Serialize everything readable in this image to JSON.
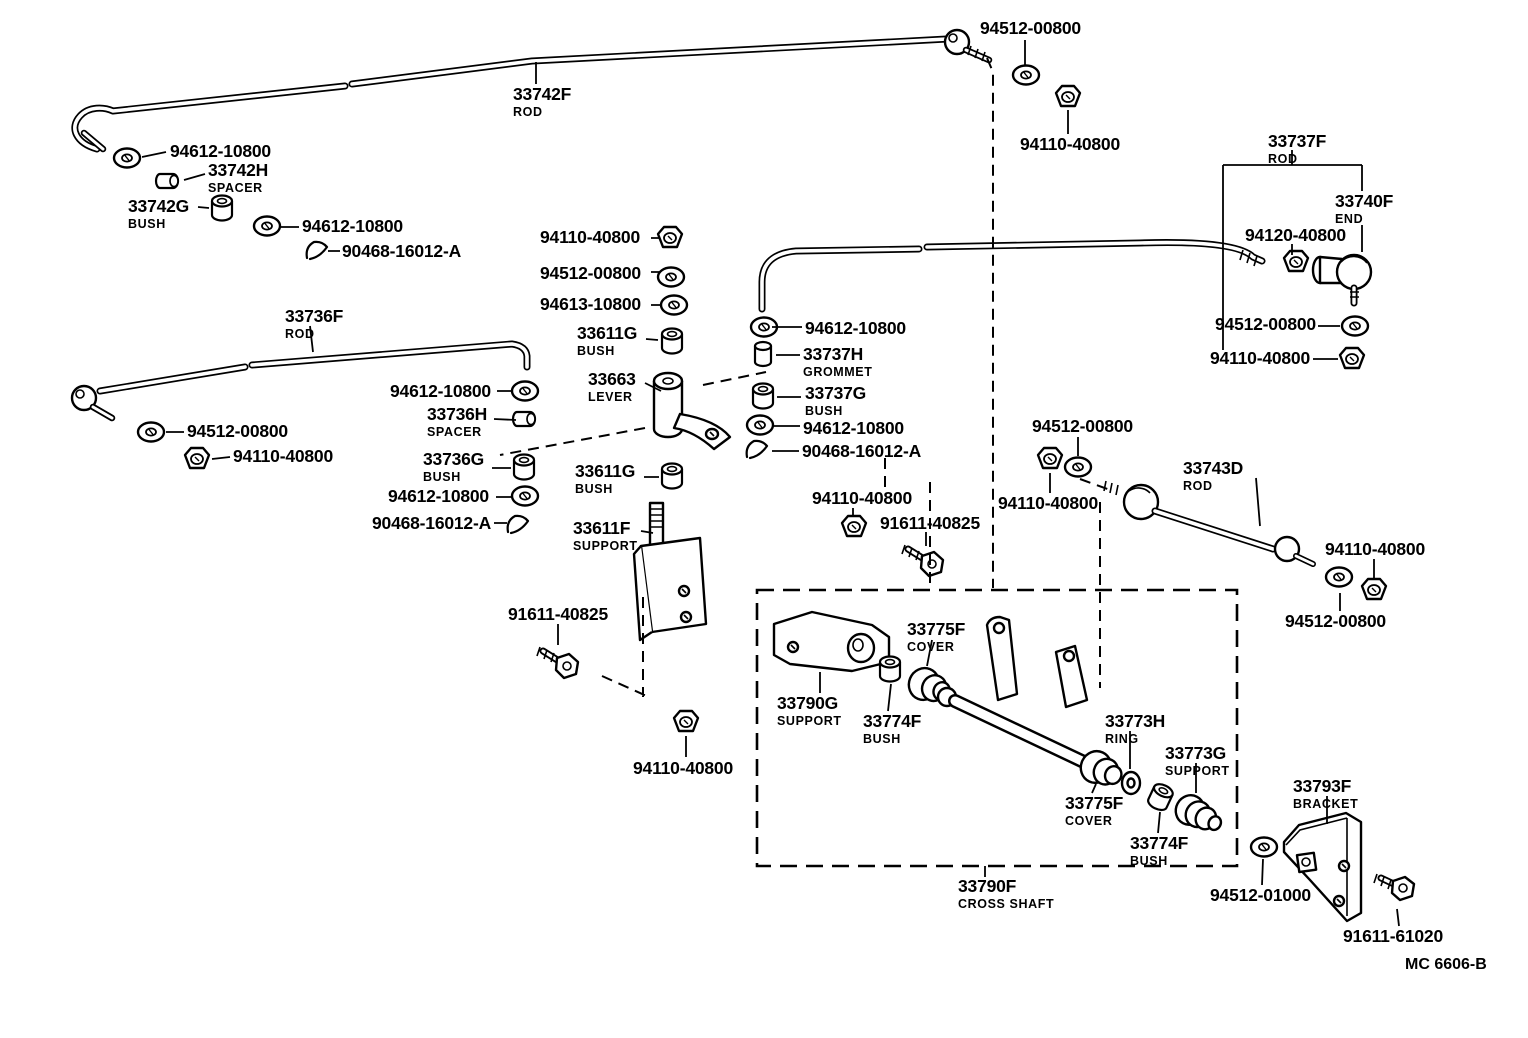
{
  "diagram": {
    "title": "Control shaft & crossshaft parts diagram",
    "drawing_code": "MC 6606-B",
    "colors": {
      "ink": "#000000",
      "paper": "#ffffff"
    },
    "labels": [
      {
        "part": "94512-00800",
        "desc": "",
        "x": 980,
        "y": 20
      },
      {
        "part": "94110-40800",
        "desc": "",
        "x": 1020,
        "y": 136
      },
      {
        "part": "94612-10800",
        "desc": "",
        "x": 170,
        "y": 143
      },
      {
        "part": "33742H",
        "desc": "SPACER",
        "x": 208,
        "y": 162
      },
      {
        "part": "33742G",
        "desc": "BUSH",
        "x": 128,
        "y": 198
      },
      {
        "part": "94612-10800",
        "desc": "",
        "x": 302,
        "y": 218
      },
      {
        "part": "90468-16012-A",
        "desc": "",
        "x": 342,
        "y": 243
      },
      {
        "part": "33742F",
        "desc": "ROD",
        "x": 513,
        "y": 86
      },
      {
        "part": "33737F",
        "desc": "ROD",
        "x": 1268,
        "y": 133
      },
      {
        "part": "33740F",
        "desc": "END",
        "x": 1335,
        "y": 193
      },
      {
        "part": "94120-40800",
        "desc": "",
        "x": 1245,
        "y": 227
      },
      {
        "part": "94110-40800",
        "desc": "",
        "x": 540,
        "y": 229
      },
      {
        "part": "94512-00800",
        "desc": "",
        "x": 540,
        "y": 265
      },
      {
        "part": "94613-10800",
        "desc": "",
        "x": 540,
        "y": 296
      },
      {
        "part": "33611G",
        "desc": "BUSH",
        "x": 577,
        "y": 325
      },
      {
        "part": "94612-10800",
        "desc": "",
        "x": 805,
        "y": 320
      },
      {
        "part": "33737H",
        "desc": "GROMMET",
        "x": 803,
        "y": 346
      },
      {
        "part": "33663",
        "desc": "LEVER",
        "x": 588,
        "y": 371
      },
      {
        "part": "33737G",
        "desc": "BUSH",
        "x": 805,
        "y": 385
      },
      {
        "part": "94612-10800",
        "desc": "",
        "x": 803,
        "y": 420
      },
      {
        "part": "90468-16012-A",
        "desc": "",
        "x": 802,
        "y": 443
      },
      {
        "part": "33736F",
        "desc": "ROD",
        "x": 285,
        "y": 308
      },
      {
        "part": "94612-10800",
        "desc": "",
        "x": 390,
        "y": 383
      },
      {
        "part": "33736H",
        "desc": "SPACER",
        "x": 427,
        "y": 406
      },
      {
        "part": "94512-00800",
        "desc": "",
        "x": 187,
        "y": 423
      },
      {
        "part": "94110-40800",
        "desc": "",
        "x": 233,
        "y": 448
      },
      {
        "part": "33736G",
        "desc": "BUSH",
        "x": 423,
        "y": 451
      },
      {
        "part": "94612-10800",
        "desc": "",
        "x": 388,
        "y": 488
      },
      {
        "part": "90468-16012-A",
        "desc": "",
        "x": 372,
        "y": 515
      },
      {
        "part": "33611G",
        "desc": "BUSH",
        "x": 575,
        "y": 463
      },
      {
        "part": "33611F",
        "desc": "SUPPORT",
        "x": 573,
        "y": 520
      },
      {
        "part": "94110-40800",
        "desc": "",
        "x": 812,
        "y": 490
      },
      {
        "part": "91611-40825",
        "desc": "",
        "x": 880,
        "y": 515
      },
      {
        "part": "94512-00800",
        "desc": "",
        "x": 1032,
        "y": 418
      },
      {
        "part": "94110-40800",
        "desc": "",
        "x": 998,
        "y": 495
      },
      {
        "part": "33743D",
        "desc": "ROD",
        "x": 1183,
        "y": 460
      },
      {
        "part": "94512-00800",
        "desc": "",
        "x": 1215,
        "y": 316
      },
      {
        "part": "94110-40800",
        "desc": "",
        "x": 1210,
        "y": 350
      },
      {
        "part": "94110-40800",
        "desc": "",
        "x": 1325,
        "y": 541
      },
      {
        "part": "94512-00800",
        "desc": "",
        "x": 1285,
        "y": 613
      },
      {
        "part": "91611-40825",
        "desc": "",
        "x": 508,
        "y": 606
      },
      {
        "part": "94110-40800",
        "desc": "",
        "x": 633,
        "y": 760
      },
      {
        "part": "33775F",
        "desc": "COVER",
        "x": 907,
        "y": 621
      },
      {
        "part": "33790G",
        "desc": "SUPPORT",
        "x": 777,
        "y": 695
      },
      {
        "part": "33774F",
        "desc": "BUSH",
        "x": 863,
        "y": 713
      },
      {
        "part": "33773H",
        "desc": "RING",
        "x": 1105,
        "y": 713
      },
      {
        "part": "33773G",
        "desc": "SUPPORT",
        "x": 1165,
        "y": 745
      },
      {
        "part": "33775F",
        "desc": "COVER",
        "x": 1065,
        "y": 795
      },
      {
        "part": "33774F",
        "desc": "BUSH",
        "x": 1130,
        "y": 835
      },
      {
        "part": "33790F",
        "desc": "CROSS SHAFT",
        "x": 958,
        "y": 878
      },
      {
        "part": "33793F",
        "desc": "BRACKET",
        "x": 1293,
        "y": 778
      },
      {
        "part": "94512-01000",
        "desc": "",
        "x": 1210,
        "y": 887
      },
      {
        "part": "91611-61020",
        "desc": "",
        "x": 1343,
        "y": 928
      }
    ]
  }
}
